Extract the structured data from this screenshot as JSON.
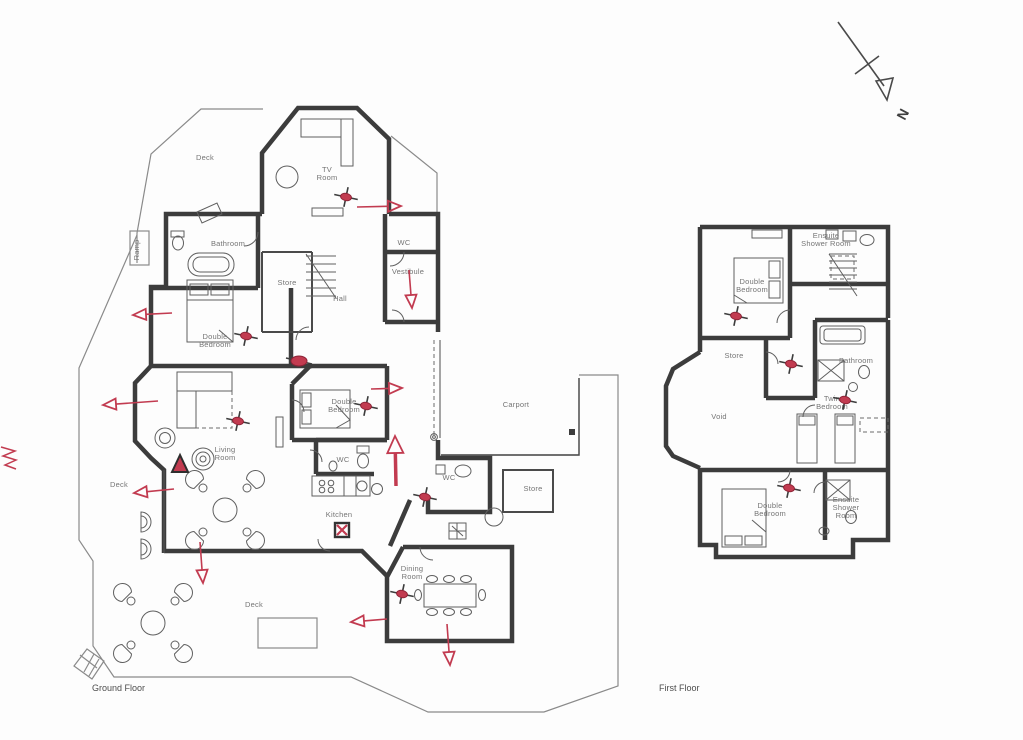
{
  "meta": {
    "width": 1023,
    "height": 740,
    "background": "#fdfdfd",
    "accent_red": "#c23b50",
    "wall_color": "#3c3c3c"
  },
  "north_marker": {
    "label": "N"
  },
  "floors": [
    {
      "id": "ground",
      "title": "Ground Floor",
      "labels": [
        {
          "id": "deck-north",
          "lines": [
            "Deck"
          ],
          "x": 205,
          "y": 160
        },
        {
          "id": "tv-room",
          "lines": [
            "TV",
            "Room"
          ],
          "x": 327,
          "y": 172
        },
        {
          "id": "ramp",
          "lines": [
            "Ramp"
          ],
          "x": 139,
          "y": 250,
          "rotate": -90
        },
        {
          "id": "bathroom",
          "lines": [
            "Bathroom"
          ],
          "x": 228,
          "y": 246
        },
        {
          "id": "store",
          "lines": [
            "Store"
          ],
          "x": 287,
          "y": 285
        },
        {
          "id": "hall",
          "lines": [
            "Hall"
          ],
          "x": 340,
          "y": 301
        },
        {
          "id": "wc-north",
          "lines": [
            "WC"
          ],
          "x": 404,
          "y": 245
        },
        {
          "id": "vestibule",
          "lines": [
            "Vestibule"
          ],
          "x": 408,
          "y": 274
        },
        {
          "id": "double-bedroom-west",
          "lines": [
            "Double",
            "Bedroom"
          ],
          "x": 215,
          "y": 339
        },
        {
          "id": "double-bedroom-mid",
          "lines": [
            "Double",
            "Bedroom"
          ],
          "x": 344,
          "y": 404
        },
        {
          "id": "living-room",
          "lines": [
            "Living",
            "Room"
          ],
          "x": 225,
          "y": 452
        },
        {
          "id": "deck-west",
          "lines": [
            "Deck"
          ],
          "x": 119,
          "y": 487
        },
        {
          "id": "wc-mid",
          "lines": [
            "WC"
          ],
          "x": 343,
          "y": 462
        },
        {
          "id": "kitchen",
          "lines": [
            "Kitchen"
          ],
          "x": 339,
          "y": 517
        },
        {
          "id": "wc-east",
          "lines": [
            "WC"
          ],
          "x": 449,
          "y": 480
        },
        {
          "id": "carport",
          "lines": [
            "Carport"
          ],
          "x": 516,
          "y": 407
        },
        {
          "id": "store-east",
          "lines": [
            "Store"
          ],
          "x": 533,
          "y": 491
        },
        {
          "id": "dining-room",
          "lines": [
            "Dining",
            "Room"
          ],
          "x": 412,
          "y": 571
        },
        {
          "id": "deck-south",
          "lines": [
            "Deck"
          ],
          "x": 254,
          "y": 607
        }
      ]
    },
    {
      "id": "first",
      "title": "First Floor",
      "labels": [
        {
          "id": "ensuite-shower-north",
          "lines": [
            "Ensuite",
            "Shower Room"
          ],
          "x": 826,
          "y": 238
        },
        {
          "id": "double-bedroom-north",
          "lines": [
            "Double",
            "Bedroom"
          ],
          "x": 752,
          "y": 284
        },
        {
          "id": "store-ff",
          "lines": [
            "Store"
          ],
          "x": 734,
          "y": 358
        },
        {
          "id": "bathroom-ff",
          "lines": [
            "Bathroom"
          ],
          "x": 856,
          "y": 363
        },
        {
          "id": "void",
          "lines": [
            "Void"
          ],
          "x": 719,
          "y": 419
        },
        {
          "id": "twin-bedroom",
          "lines": [
            "Twin",
            "Bedroom"
          ],
          "x": 832,
          "y": 401
        },
        {
          "id": "double-bedroom-south",
          "lines": [
            "Double",
            "Bedroom"
          ],
          "x": 770,
          "y": 508
        },
        {
          "id": "ensuite-shower-south",
          "lines": [
            "Ensuite",
            "Shower",
            "Room"
          ],
          "x": 846,
          "y": 502
        }
      ]
    }
  ],
  "annotations": {
    "detectors": [
      {
        "x": 346,
        "y": 197
      },
      {
        "x": 246,
        "y": 336
      },
      {
        "x": 238,
        "y": 421
      },
      {
        "x": 366,
        "y": 406
      },
      {
        "x": 425,
        "y": 497
      },
      {
        "x": 402,
        "y": 594
      },
      {
        "x": 736,
        "y": 316
      },
      {
        "x": 791,
        "y": 364
      },
      {
        "x": 845,
        "y": 400
      },
      {
        "x": 789,
        "y": 488
      }
    ],
    "hall_spot": {
      "x": 299,
      "y": 361
    },
    "kitchen_cross_box": {
      "x": 342,
      "y": 530
    },
    "escape_arrows": [
      {
        "x1": 357,
        "y1": 207,
        "x2": 401,
        "y2": 206
      },
      {
        "x1": 409,
        "y1": 270,
        "x2": 412,
        "y2": 308
      },
      {
        "x1": 172,
        "y1": 313,
        "x2": 133,
        "y2": 315
      },
      {
        "x1": 158,
        "y1": 401,
        "x2": 103,
        "y2": 405
      },
      {
        "x1": 174,
        "y1": 489,
        "x2": 134,
        "y2": 493
      },
      {
        "x1": 200,
        "y1": 542,
        "x2": 203,
        "y2": 583
      },
      {
        "x1": 396,
        "y1": 486,
        "x2": 395,
        "y2": 436,
        "thick": true
      },
      {
        "x1": 371,
        "y1": 389,
        "x2": 402,
        "y2": 388
      },
      {
        "x1": 387,
        "y1": 619,
        "x2": 351,
        "y2": 622
      },
      {
        "x1": 447,
        "y1": 624,
        "x2": 450,
        "y2": 665
      }
    ],
    "solid_triangle": {
      "x": 180,
      "y": 464
    },
    "edge_scribble": {
      "x": 1,
      "y": 447
    }
  }
}
